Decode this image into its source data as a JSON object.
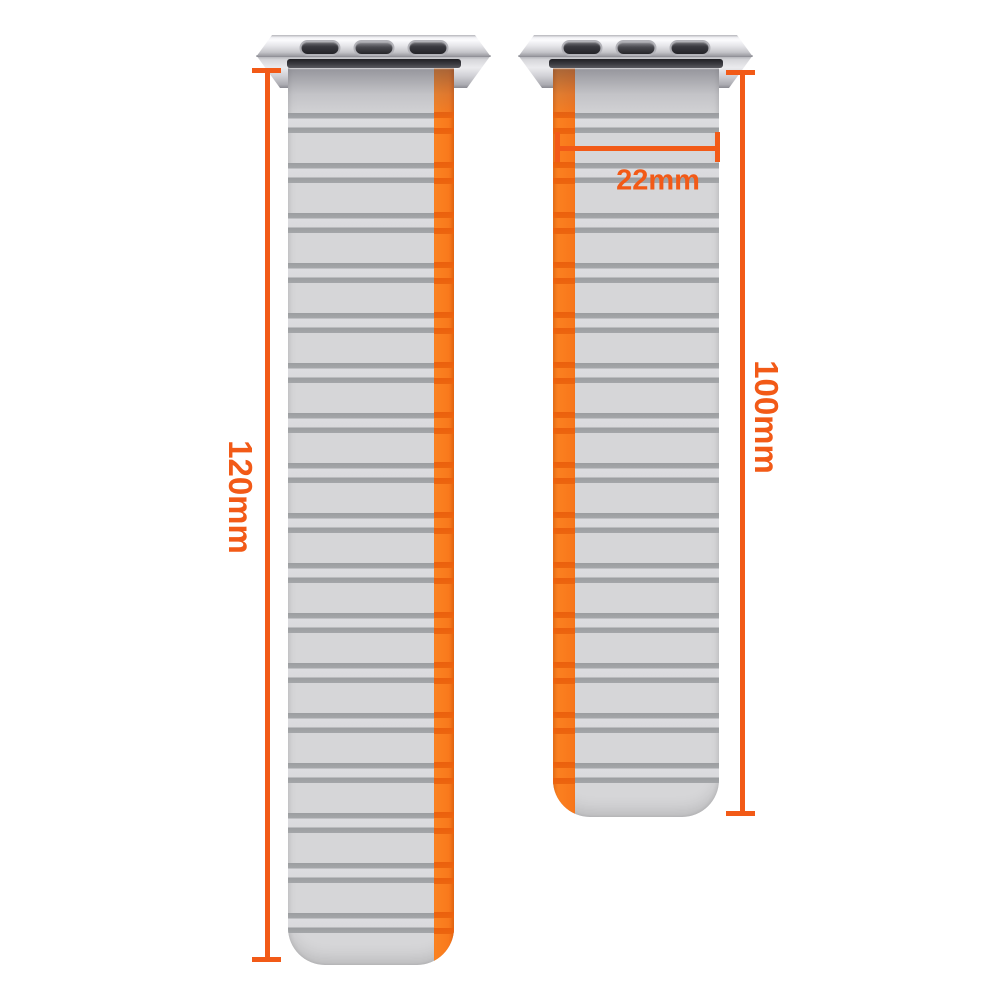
{
  "image": {
    "type": "product-dimension-diagram",
    "subject": "magnetic silicone watch bands with metal adapters",
    "background": "#ffffff"
  },
  "colors": {
    "dimension_accent": "#f25a17",
    "strap_body": "#d6d6d8",
    "strap_ridge": "#9b9da0",
    "stripe_orange": "#f8761a",
    "stripe_ridge_orange": "#eb600d",
    "adapter_silver": "#d9d9dd",
    "adapter_slot_dark": "#37373b"
  },
  "annotations": {
    "left_band_length": "120mm",
    "right_band_length": "100mm",
    "band_width": "22mm"
  },
  "bands": [
    {
      "name": "left-band",
      "length_label": "120mm",
      "stripe_side": "right",
      "ridge_pairs": 17
    },
    {
      "name": "right-band",
      "length_label": "100mm",
      "stripe_side": "left",
      "ridge_pairs": 14
    }
  ]
}
